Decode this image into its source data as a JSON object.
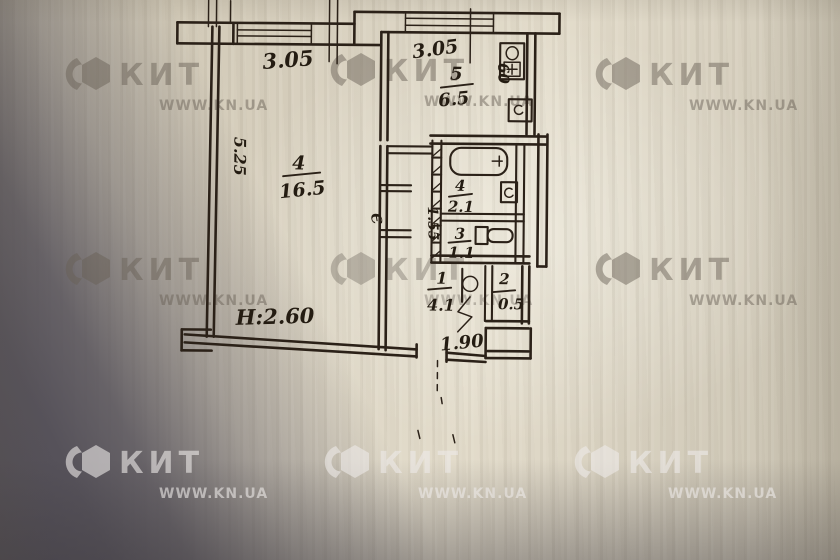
{
  "watermark": {
    "brand": "КИТ",
    "site": "WWW.KN.UA"
  },
  "plan": {
    "height_note": "Н:2.60",
    "corridor_mark": "Є",
    "dims": {
      "living_width": "3.05",
      "kitchen_width": "3.05",
      "side_depth": "5.25",
      "corridor_width": "1.55",
      "entry_width": "1.90",
      "kitchen_unit": "60"
    },
    "rooms": {
      "living": {
        "number": "4",
        "area": "16.5"
      },
      "kitchen": {
        "number": "5",
        "area": "6.5"
      },
      "bath": {
        "number": "4",
        "area": "2.1"
      },
      "toilet": {
        "number": "3",
        "area": "1.1"
      },
      "hall": {
        "number": "1",
        "area": "4.1"
      },
      "closet": {
        "number": "2",
        "area": "0.5"
      }
    }
  },
  "colors": {
    "paper": "#d8d1c0",
    "ink": "#2b2118",
    "table_shadow": "#55515a"
  }
}
